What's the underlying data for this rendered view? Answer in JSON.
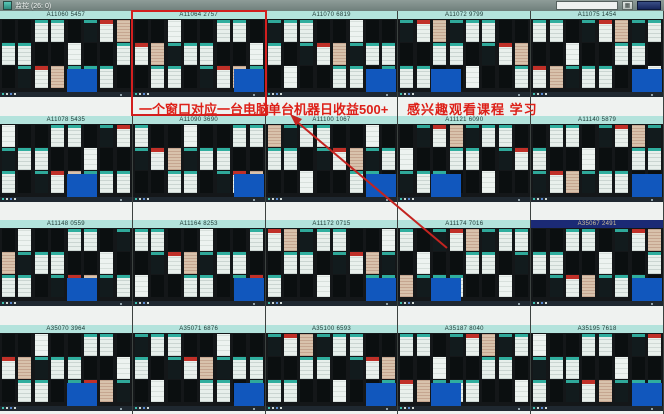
{
  "window": {
    "title": "监控 (26: 0)"
  },
  "toolbar": {
    "search_value": "",
    "search_placeholder": ""
  },
  "panels": [
    {
      "id": "A11060 5457",
      "selected": false
    },
    {
      "id": "A11064 2757",
      "selected": false
    },
    {
      "id": "A11070 6819",
      "selected": false
    },
    {
      "id": "A11072 9799",
      "selected": false
    },
    {
      "id": "A11075 1454",
      "selected": false
    },
    {
      "id": "A11078 5435",
      "selected": false
    },
    {
      "id": "A11090 3690",
      "selected": false
    },
    {
      "id": "A11100 1067",
      "selected": false
    },
    {
      "id": "A11121 6090",
      "selected": false
    },
    {
      "id": "A11140 5879",
      "selected": false
    },
    {
      "id": "A11148 0559",
      "selected": false
    },
    {
      "id": "A11164 8253",
      "selected": false
    },
    {
      "id": "A11172 0715",
      "selected": false
    },
    {
      "id": "A11174 7016",
      "selected": false
    },
    {
      "id": "A35067 2491",
      "selected": true
    },
    {
      "id": "A35070 3964",
      "selected": false
    },
    {
      "id": "A35071 6876",
      "selected": false
    },
    {
      "id": "A35100 6593",
      "selected": false
    },
    {
      "id": "A35187 8040",
      "selected": false
    },
    {
      "id": "A35195 7618",
      "selected": false
    }
  ],
  "annotations": {
    "label_window": "一个窗口对应一台电脑",
    "label_income": "单台机器日收益500+",
    "label_course": "感兴趣观看课程 学习",
    "annotation_color": "#d21f1f"
  },
  "colors": {
    "panel_header": "#b3e3dc",
    "panel_header_selected": "#1b2a75",
    "desktop_blue": "#1157bd",
    "titlebar": "#7e8e8a"
  }
}
